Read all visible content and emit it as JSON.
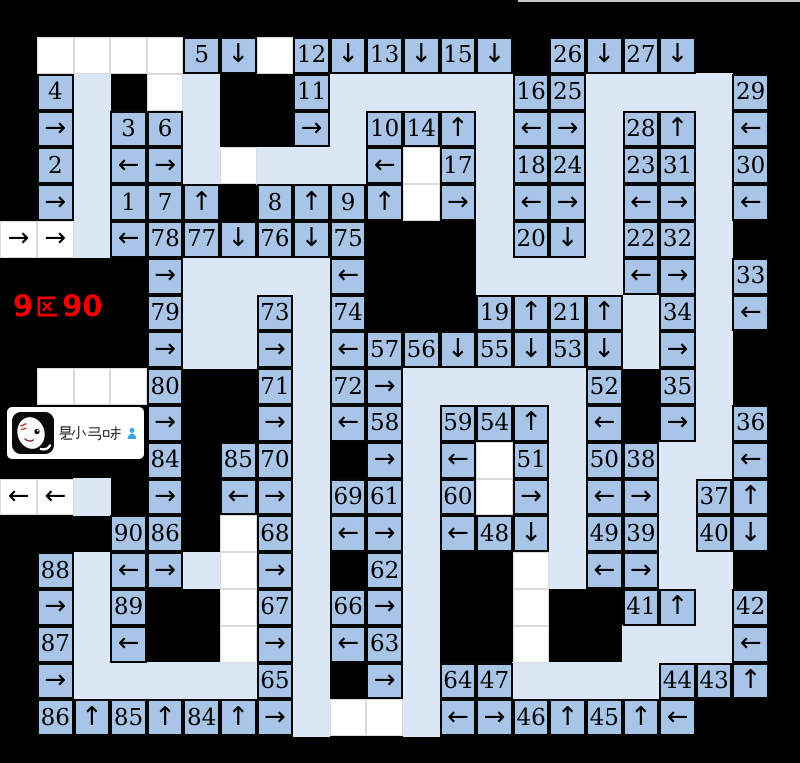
{
  "colors": {
    "background": "#000000",
    "cell_blue": "#a8c5e7",
    "path_blue": "#dbe7f4",
    "white_cell": "#ffffff",
    "cell_border": "#060606",
    "label_red": "#ee0000",
    "watermark_bg": "#ffffff",
    "person_icon_blue": "#3aa7dd",
    "top_line_gray": "#c8c8c8"
  },
  "overlay": {
    "section_label": {
      "full": "9区90",
      "prefix": "9",
      "cjk_char": "区",
      "suffix": "90"
    },
    "watermark": {
      "text": "是小马呀",
      "logo": "panda-horse-avatar",
      "icon": "person-icon"
    }
  },
  "legend": {
    "arrow_up": "↑",
    "arrow_down": "↓",
    "arrow_left": "←",
    "arrow_right": "→"
  },
  "grid": {
    "rows": 21,
    "cols": 22,
    "col_edges": [
      0,
      37,
      73.6,
      110.2,
      146.8,
      183.4,
      220,
      256.6,
      293.2,
      329.8,
      366.4,
      403,
      439.6,
      476.2,
      512.8,
      549.4,
      586,
      622.6,
      659.2,
      695.8,
      732.4,
      769,
      800
    ],
    "row_edges": [
      0,
      37,
      73.8,
      110.6,
      147.4,
      184.2,
      221,
      257.8,
      294.6,
      331.4,
      368.2,
      405,
      441.8,
      478.6,
      515.4,
      552.2,
      589,
      625.8,
      662.6,
      699.4,
      736.2,
      763
    ],
    "token_key": {
      ".": "black background",
      "p": "light path cell",
      "w": "white empty cell",
      "W<": "white cell with left arrow",
      "W>": "white cell with right arrow",
      "<": "blue cell arrow left",
      ">": "blue cell arrow right",
      "^": "blue cell arrow up",
      "v": "blue cell arrow down",
      "n": "any number token is a blue numbered cell"
    },
    "cells": [
      [
        ".",
        ".",
        ".",
        ".",
        ".",
        ".",
        ".",
        ".",
        ".",
        ".",
        ".",
        ".",
        ".",
        ".",
        ".",
        ".",
        ".",
        ".",
        ".",
        ".",
        ".",
        "."
      ],
      [
        ".",
        "w",
        "w",
        "w",
        "w",
        "5",
        "v",
        "w",
        "12",
        "v",
        "13",
        "v",
        "15",
        "v",
        ".",
        "26",
        "v",
        "27",
        "v",
        ".",
        ".",
        "."
      ],
      [
        ".",
        "4",
        "p",
        ".",
        "w",
        "p",
        ".",
        ".",
        "11",
        "p",
        "p",
        "p",
        "p",
        "p",
        "16",
        "25",
        "p",
        "p",
        "p",
        "p",
        "29",
        "."
      ],
      [
        ".",
        ">",
        "p",
        "3",
        "6",
        "p",
        ".",
        ".",
        ">",
        "p",
        "10",
        "14",
        "^",
        "p",
        "<",
        ">",
        "p",
        "28",
        "^",
        "p",
        "<",
        "."
      ],
      [
        ".",
        "2",
        "p",
        "<",
        ">",
        "p",
        "w",
        "p",
        "p",
        "p",
        "<",
        "w",
        "17",
        "p",
        "18",
        "24",
        "p",
        "23",
        "31",
        "p",
        "30",
        "."
      ],
      [
        ".",
        ">",
        "p",
        "1",
        "7",
        "^",
        ".",
        "8",
        "^",
        "9",
        "^",
        "w",
        ">",
        "p",
        "<",
        ">",
        "p",
        "<",
        ">",
        "p",
        "<",
        "."
      ],
      [
        "W>",
        "W>",
        "p",
        "<",
        "78",
        "77",
        "v",
        "76",
        "v",
        "75",
        ".",
        ".",
        ".",
        "p",
        "20",
        "v",
        "p",
        "22",
        "32",
        "p",
        ".",
        "."
      ],
      [
        ".",
        ".",
        ".",
        ".",
        ">",
        "p",
        "p",
        "p",
        "p",
        "<",
        ".",
        ".",
        ".",
        "p",
        "p",
        "p",
        "p",
        "<",
        ">",
        "p",
        "33",
        "."
      ],
      [
        ".",
        ".",
        ".",
        ".",
        "79",
        "p",
        "p",
        "73",
        "p",
        "74",
        ".",
        ".",
        ".",
        "19",
        "^",
        "21",
        "^",
        "p",
        "34",
        "p",
        "<",
        "."
      ],
      [
        ".",
        ".",
        ".",
        ".",
        ">",
        "p",
        "p",
        ">",
        "p",
        "<",
        "57",
        "56",
        "v",
        "55",
        "v",
        "53",
        "v",
        "p",
        ">",
        "p",
        ".",
        "."
      ],
      [
        ".",
        "w",
        "w",
        "w",
        "80",
        ".",
        ".",
        "71",
        "p",
        "72",
        ">",
        "p",
        "p",
        "p",
        "p",
        "p",
        "52",
        ".",
        "35",
        "p",
        ".",
        "."
      ],
      [
        ".",
        ".",
        ".",
        ".",
        ">",
        ".",
        ".",
        ">",
        "p",
        "<",
        "58",
        "p",
        "59",
        "54",
        "^",
        "p",
        "<",
        ".",
        ">",
        "p",
        "36",
        "."
      ],
      [
        ".",
        ".",
        ".",
        ".",
        "84",
        ".",
        "85",
        "70",
        "p",
        ".",
        ">",
        "p",
        "<",
        "w",
        "51",
        "p",
        "50",
        "38",
        "p",
        "p",
        "<",
        "."
      ],
      [
        "W<",
        "W<",
        "p",
        ".",
        ">",
        ".",
        "<",
        ">",
        "p",
        "69",
        "61",
        "p",
        "60",
        "w",
        ">",
        "p",
        "<",
        ">",
        "p",
        "37",
        "^",
        "."
      ],
      [
        ".",
        ".",
        ".",
        "90",
        "86",
        ".",
        "w",
        "68",
        "p",
        "<",
        ">",
        "p",
        "<",
        "48",
        "v",
        "p",
        "49",
        "39",
        "p",
        "40",
        "v",
        "."
      ],
      [
        ".",
        "88",
        "p",
        "<",
        ">",
        "p",
        "w",
        ">",
        "p",
        ".",
        "62",
        "p",
        ".",
        ".",
        "w",
        "p",
        "<",
        ">",
        "p",
        "p",
        ".",
        "."
      ],
      [
        ".",
        ">",
        "p",
        "89",
        ".",
        ".",
        "w",
        "67",
        "p",
        "66",
        ">",
        "p",
        ".",
        ".",
        "w",
        ".",
        ".",
        "41",
        "^",
        "p",
        "42",
        "."
      ],
      [
        ".",
        "87",
        "p",
        "<",
        ".",
        ".",
        "w",
        ">",
        "p",
        "<",
        "63",
        "p",
        ".",
        ".",
        "w",
        ".",
        ".",
        "p",
        "p",
        "p",
        "<",
        "."
      ],
      [
        ".",
        ">",
        "p",
        "p",
        "p",
        "p",
        "p",
        "65",
        "p",
        ".",
        ">",
        "p",
        "64",
        "47",
        "p",
        "p",
        "p",
        "p",
        "44",
        "43",
        "^",
        "."
      ],
      [
        ".",
        "86",
        "^",
        "85",
        "^",
        "84",
        "^",
        ">",
        "p",
        "w",
        "w",
        "p",
        "<",
        ">",
        "46",
        "^",
        "45",
        "^",
        "<",
        ".",
        ".",
        "."
      ],
      [
        ".",
        ".",
        ".",
        ".",
        ".",
        ".",
        ".",
        ".",
        ".",
        ".",
        ".",
        ".",
        ".",
        ".",
        ".",
        ".",
        ".",
        ".",
        ".",
        ".",
        ".",
        "."
      ]
    ]
  }
}
